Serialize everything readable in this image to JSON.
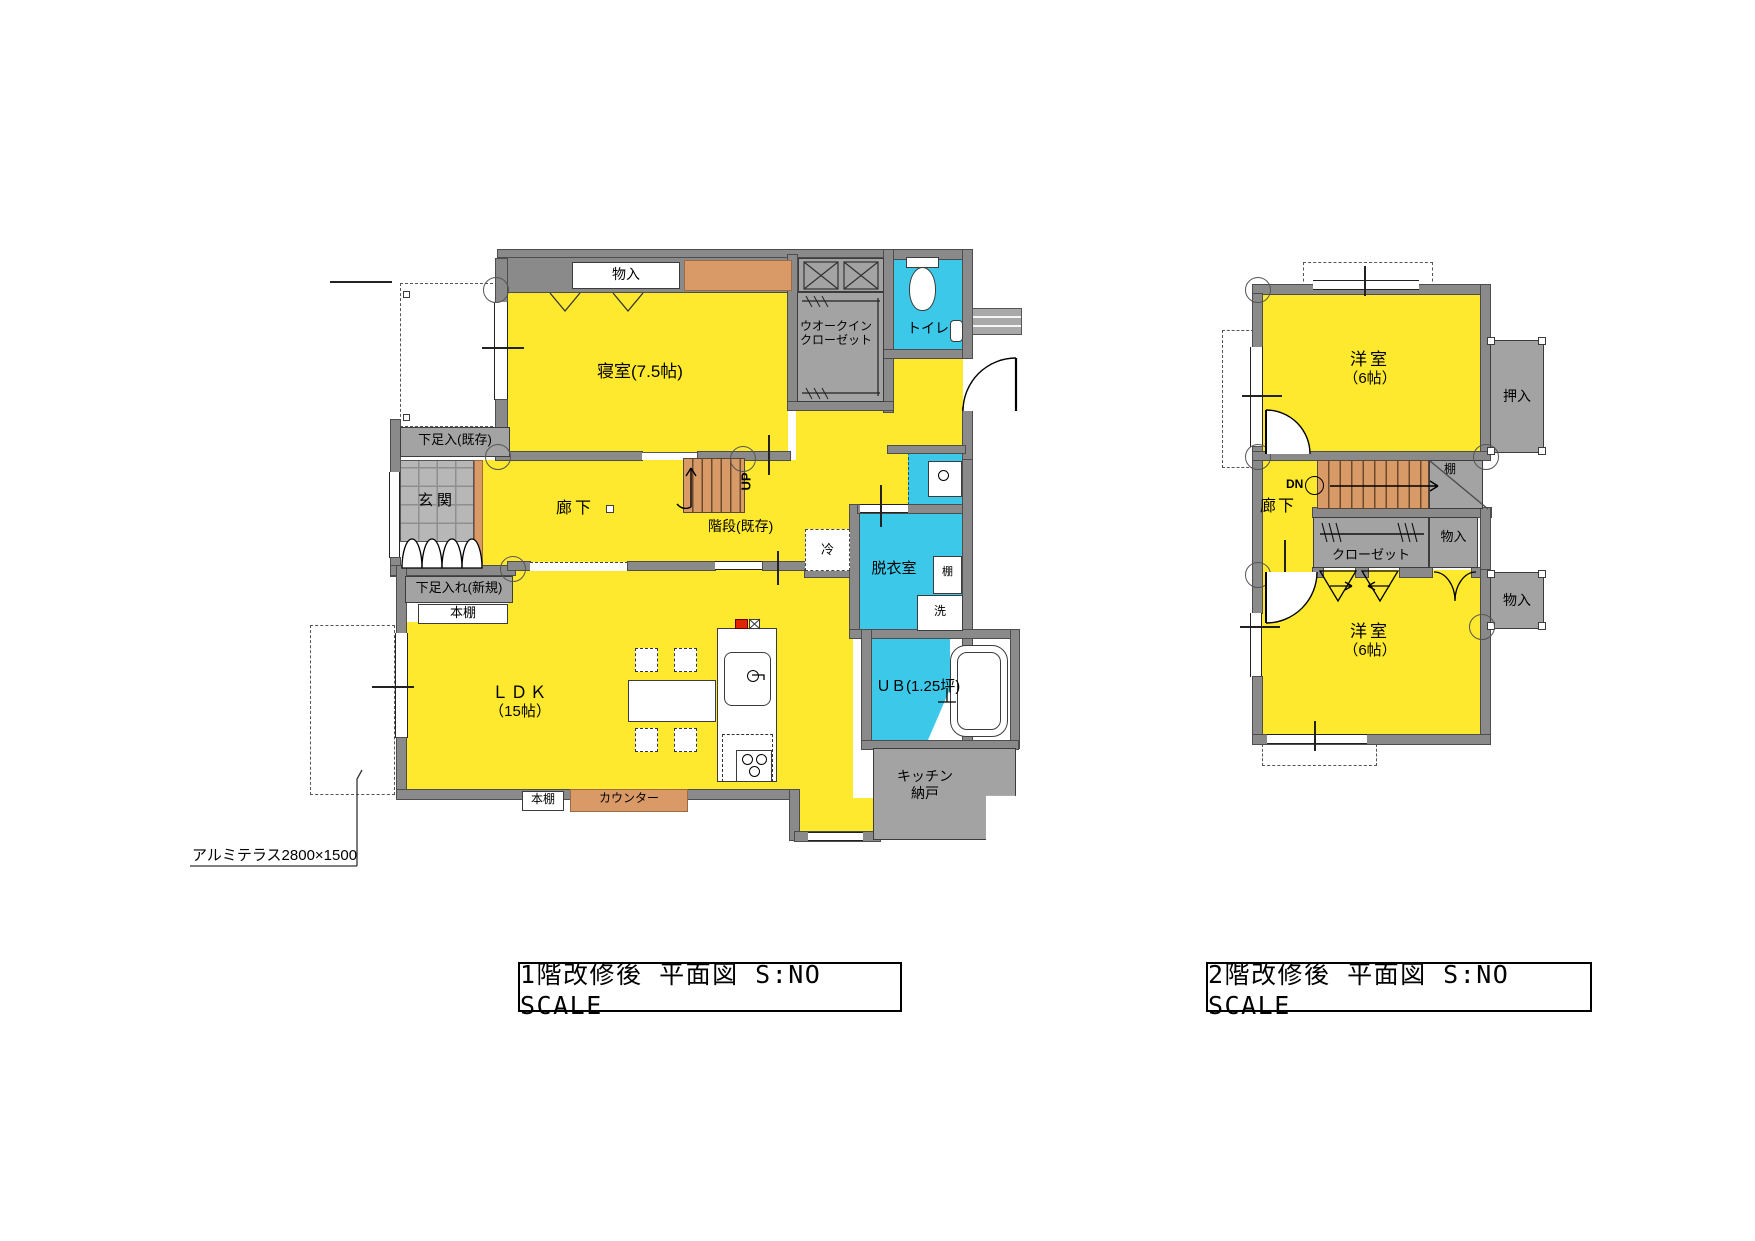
{
  "document": {
    "type": "architectural-floor-plan",
    "background": "#ffffff"
  },
  "colors": {
    "room_yellow": "#ffe92e",
    "wet_area_cyan": "#3cc8e8",
    "wall_gray": "#8a8a8a",
    "storage_gray": "#a3a3a3",
    "stair_counter_orange": "#d89a67",
    "entrance_tile_gray": "#b7b7b7",
    "stove_alert_red": "#e32400",
    "line_black": "#000000"
  },
  "floor1": {
    "title": "1階改修後 平面図 S:NO SCALE",
    "labels": {
      "monoire_top": "物入",
      "bedroom": "寝室(7.5帖)",
      "wic1": "ウオークイン",
      "wic2": "クローゼット",
      "toilet": "トイレ",
      "shitaire_existing": "下足入(既存)",
      "genkan": "玄関",
      "corridor": "廊下",
      "stair": "階段(既存)",
      "up": "UP",
      "shitaire_new": "下足入れ(新規)",
      "bookshelf_upper": "本棚",
      "fridge": "冷",
      "datsuishitsu": "脱衣室",
      "shelf": "棚",
      "washer": "洗",
      "ldk1": "ＬＤＫ",
      "ldk2": "（15帖）",
      "ub": "ＵＢ(1.25坪)",
      "kitchen_storage1": "キッチン",
      "kitchen_storage2": "納戸",
      "bookshelf_lower": "本棚",
      "counter": "カウンター",
      "terrace_note": "アルミテラス2800×1500"
    }
  },
  "floor2": {
    "title": "2階改修後 平面図 S:NO SCALE",
    "labels": {
      "room_upper1": "洋室",
      "room_upper2": "（6帖）",
      "oshiire": "押入",
      "shelf": "棚",
      "dn": "DN",
      "corridor": "廊下",
      "closet": "クローゼット",
      "monoire_upper": "物入",
      "monoire_lower": "物入",
      "room_lower1": "洋室",
      "room_lower2": "（6帖）"
    }
  }
}
